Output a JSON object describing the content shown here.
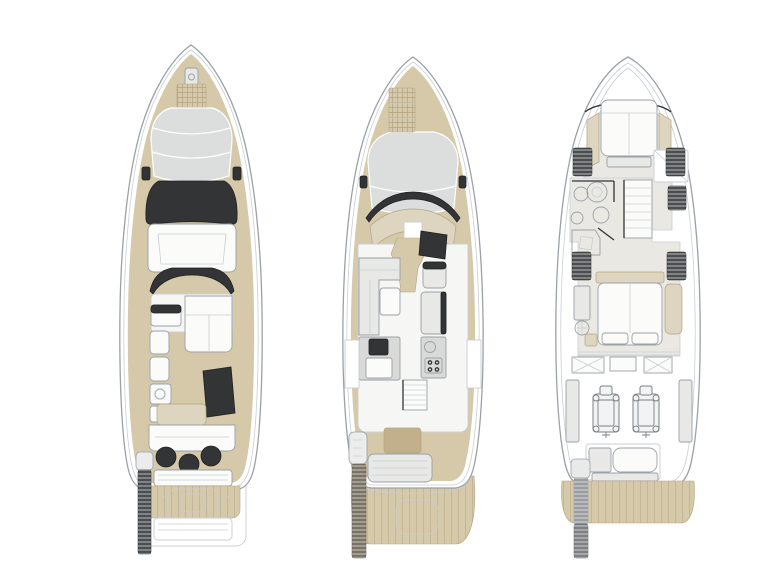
{
  "canvas": {
    "width": 768,
    "height": 576,
    "background": "#ffffff"
  },
  "colors": {
    "bg": "#ffffff",
    "line": "#9aa1a7",
    "line-light": "#c9ced3",
    "teak": "#d6c9aa",
    "teak-dark": "#c2b08a",
    "teak-line": "#b3a483",
    "beige": "#ded5c0",
    "sunpad": "#dcdddd",
    "dark": "#323436",
    "dark2": "#1f2123",
    "furn-white": "#fbfbfa",
    "furn-gray": "#e8e8e6",
    "furn-gray2": "#d9d9d7",
    "floor": "#eae8e3",
    "hatch": "#4b4e50",
    "metal": "#9a9da0",
    "passerelle-wood": "#7b7365",
    "eng-line": "#7b8084"
  },
  "decks": [
    {
      "id": "flybridge-deck"
    },
    {
      "id": "main-deck"
    },
    {
      "id": "lower-deck"
    }
  ]
}
